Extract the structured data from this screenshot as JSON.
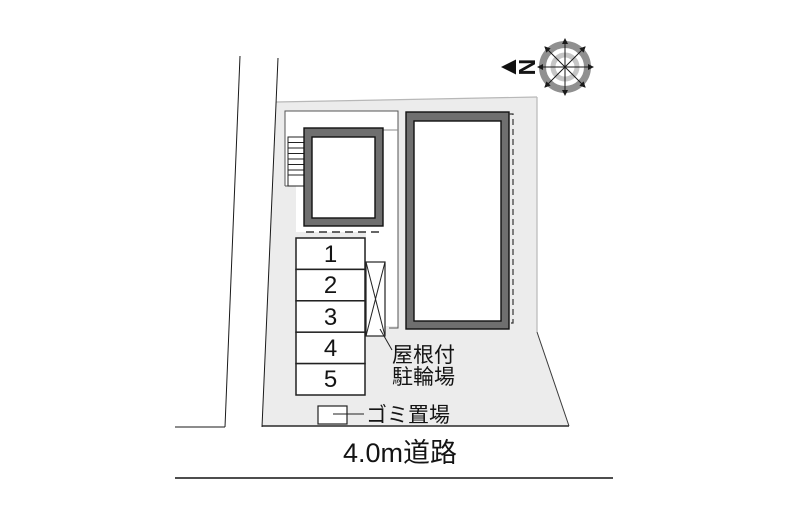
{
  "compass": {
    "north_label": "N"
  },
  "parking_spaces": [
    "1",
    "2",
    "3",
    "4",
    "5"
  ],
  "labels": {
    "bike_shed_line1": "屋根付",
    "bike_shed_line2": "駐輪場",
    "trash_area": "ゴミ置場",
    "road": "4.0m道路"
  },
  "colors": {
    "site_fill": "#ececec",
    "building_band": "#6f6f6f",
    "building_inner": "#ffffff",
    "outline_dark": "#1a1a1a",
    "thin_line": "#555555",
    "site_edge_light": "#b8b8b8",
    "compass_outer_ring": "#909090",
    "compass_inner_ring": "#c6c6c6"
  }
}
